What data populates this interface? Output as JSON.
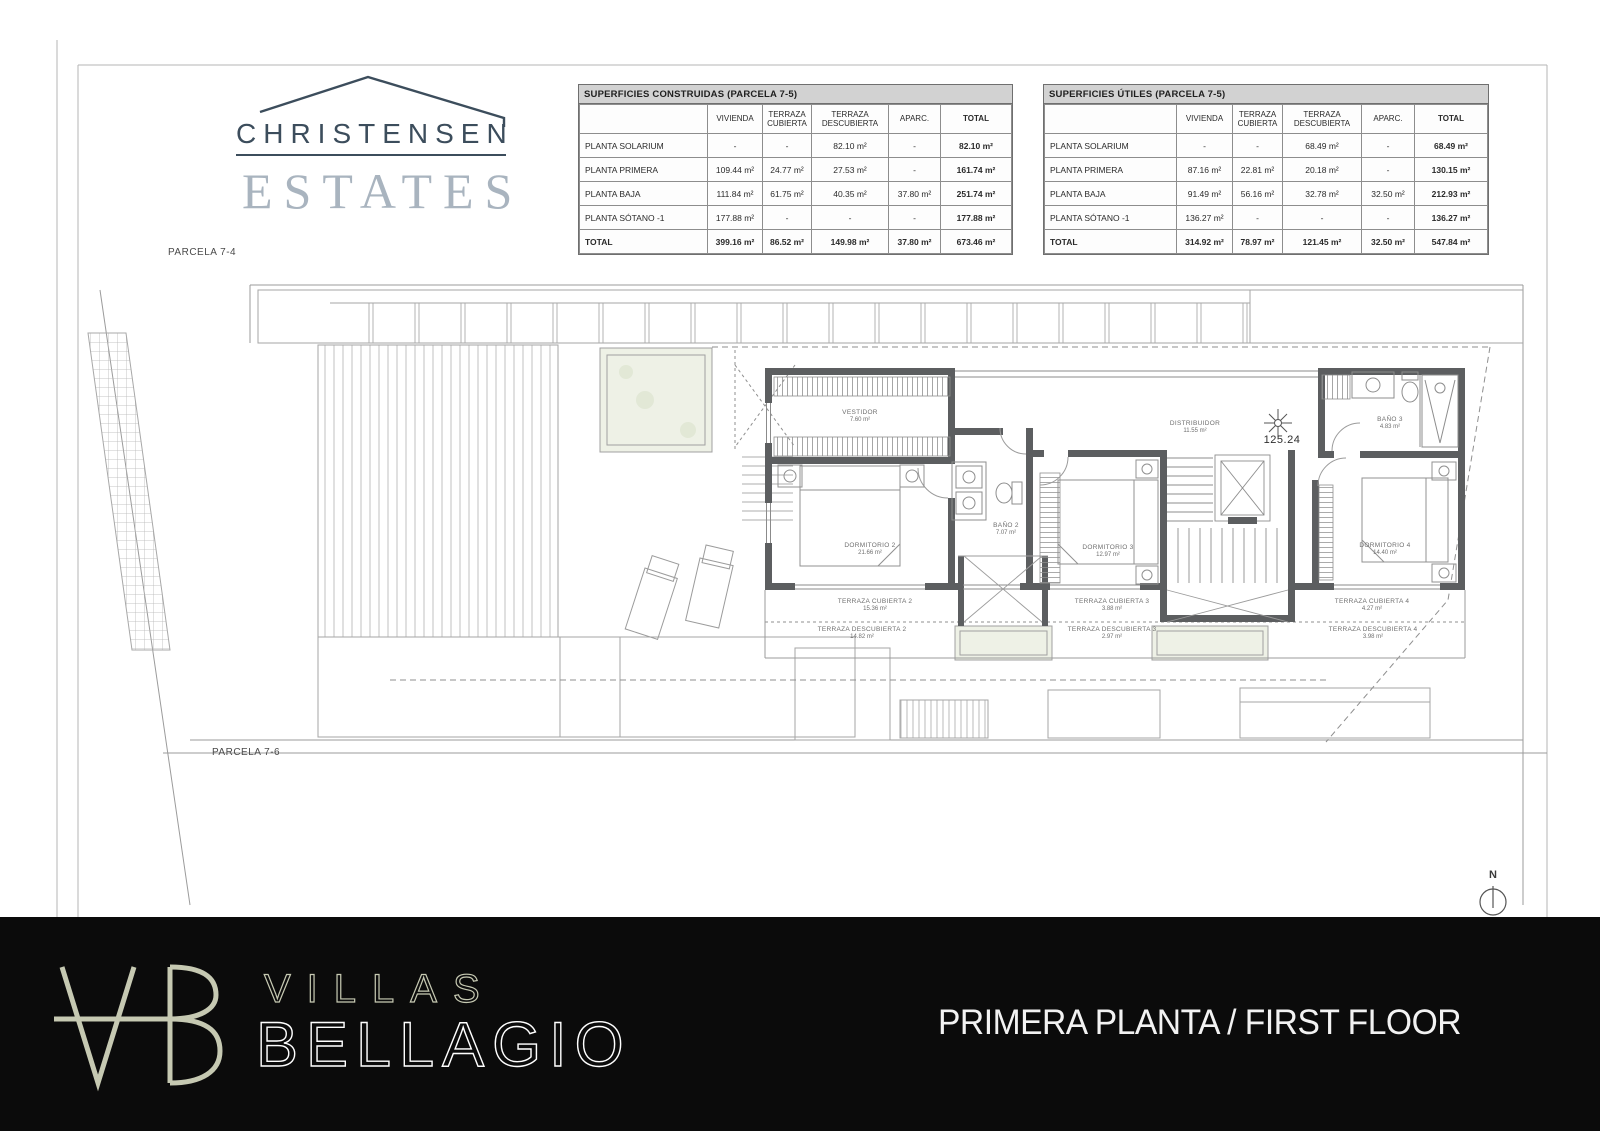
{
  "logo": {
    "line1": "CHRISTENSEN",
    "line2": "ESTATES"
  },
  "tables": [
    {
      "title": "SUPERFICIES CONSTRUIDAS (PARCELA 7-5)",
      "columns": [
        "",
        "VIVIENDA",
        "TERRAZA CUBIERTA",
        "TERRAZA DESCUBIERTA",
        "APARC.",
        "TOTAL"
      ],
      "rows": [
        [
          "PLANTA SOLARIUM",
          "-",
          "-",
          "82.10 m²",
          "-",
          "82.10 m²"
        ],
        [
          "PLANTA PRIMERA",
          "109.44 m²",
          "24.77 m²",
          "27.53 m²",
          "-",
          "161.74 m²"
        ],
        [
          "PLANTA BAJA",
          "111.84 m²",
          "61.75 m²",
          "40.35 m²",
          "37.80 m²",
          "251.74 m²"
        ],
        [
          "PLANTA SÓTANO -1",
          "177.88 m²",
          "-",
          "-",
          "-",
          "177.88 m²"
        ],
        [
          "TOTAL",
          "399.16 m²",
          "86.52 m²",
          "149.98 m²",
          "37.80 m²",
          "673.46 m²"
        ]
      ]
    },
    {
      "title": "SUPERFICIES ÚTILES (PARCELA 7-5)",
      "columns": [
        "",
        "VIVIENDA",
        "TERRAZA CUBIERTA",
        "TERRAZA DESCUBIERTA",
        "APARC.",
        "TOTAL"
      ],
      "rows": [
        [
          "PLANTA SOLARIUM",
          "-",
          "-",
          "68.49 m²",
          "-",
          "68.49 m²"
        ],
        [
          "PLANTA PRIMERA",
          "87.16 m²",
          "22.81 m²",
          "20.18 m²",
          "-",
          "130.15 m²"
        ],
        [
          "PLANTA BAJA",
          "91.49 m²",
          "56.16 m²",
          "32.78 m²",
          "32.50 m²",
          "212.93 m²"
        ],
        [
          "PLANTA SÓTANO -1",
          "136.27 m²",
          "-",
          "-",
          "-",
          "136.27 m²"
        ],
        [
          "TOTAL",
          "314.92 m²",
          "78.97 m²",
          "121.45 m²",
          "32.50 m²",
          "547.84 m²"
        ]
      ]
    }
  ],
  "plan": {
    "parcela_top": "PARCELA 7-4",
    "parcela_bottom": "PARCELA 7-6",
    "level_mark": "125.24",
    "north": "N",
    "rooms": [
      {
        "name": "VESTIDOR",
        "area": "7.60 m²"
      },
      {
        "name": "DORMITORIO 2",
        "area": "21.66 m²"
      },
      {
        "name": "BAÑO 2",
        "area": "7.07 m²"
      },
      {
        "name": "DISTRIBUIDOR",
        "area": "11.55 m²"
      },
      {
        "name": "DORMITORIO 3",
        "area": "12.97 m²"
      },
      {
        "name": "BAÑO 3",
        "area": "4.83 m²"
      },
      {
        "name": "DORMITORIO 4",
        "area": "14.40 m²"
      },
      {
        "name": "TERRAZA CUBIERTA 2",
        "area": "15.36 m²"
      },
      {
        "name": "TERRAZA DESCUBIERTA 2",
        "area": "14.82 m²"
      },
      {
        "name": "TERRAZA CUBIERTA 3",
        "area": "3.88 m²"
      },
      {
        "name": "TERRAZA DESCUBIERTA 3",
        "area": "2.97 m²"
      },
      {
        "name": "TERRAZA CUBIERTA 4",
        "area": "4.27 m²"
      },
      {
        "name": "TERRAZA DESCUBIERTA 4",
        "area": "3.98 m²"
      }
    ]
  },
  "footer": {
    "brand_line1": "VILLAS",
    "brand_line2": "BELLAGIO",
    "plan_title": "PRIMERA PLANTA / FIRST FLOOR"
  },
  "colors": {
    "logo_navy": "#3c4d5c",
    "logo_gray": "#a9b4bf",
    "footer_bg": "#0b0b0b",
    "footer_sage": "#c6c9b2",
    "wall": "#5c5e60",
    "line": "#9b9b9b"
  }
}
